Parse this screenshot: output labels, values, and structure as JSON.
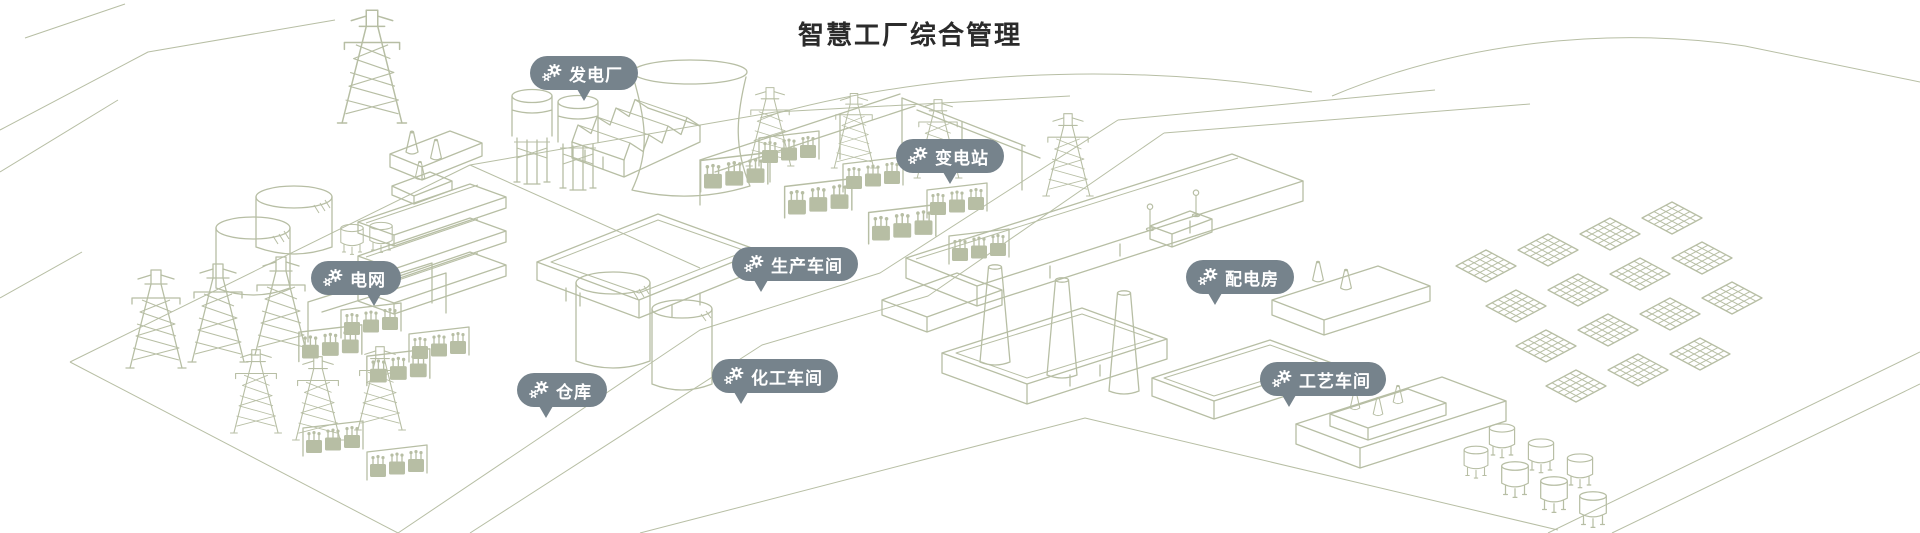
{
  "page": {
    "title": "智慧工厂综合管理"
  },
  "colors": {
    "line_art": "#b7bea4",
    "bubble_bg": "#76838c",
    "bubble_text": "#ffffff",
    "title_text": "#2b2b2b",
    "background": "#ffffff"
  },
  "icon": {
    "name": "gears-icon"
  },
  "labels": [
    {
      "id": "power-plant",
      "text": "发电厂",
      "x": 530,
      "y": 56,
      "tail": "center"
    },
    {
      "id": "substation",
      "text": "变电站",
      "x": 896,
      "y": 139,
      "tail": "center"
    },
    {
      "id": "power-grid",
      "text": "电网",
      "x": 311,
      "y": 261,
      "tail": "right"
    },
    {
      "id": "production-workshop",
      "text": "生产车间",
      "x": 732,
      "y": 247,
      "tail": "left"
    },
    {
      "id": "distribution-room",
      "text": "配电房",
      "x": 1186,
      "y": 260,
      "tail": "left"
    },
    {
      "id": "warehouse",
      "text": "仓库",
      "x": 517,
      "y": 373,
      "tail": "left"
    },
    {
      "id": "chemical-workshop",
      "text": "化工车间",
      "x": 712,
      "y": 359,
      "tail": "left"
    },
    {
      "id": "process-workshop",
      "text": "工艺车间",
      "x": 1260,
      "y": 362,
      "tail": "left"
    }
  ]
}
